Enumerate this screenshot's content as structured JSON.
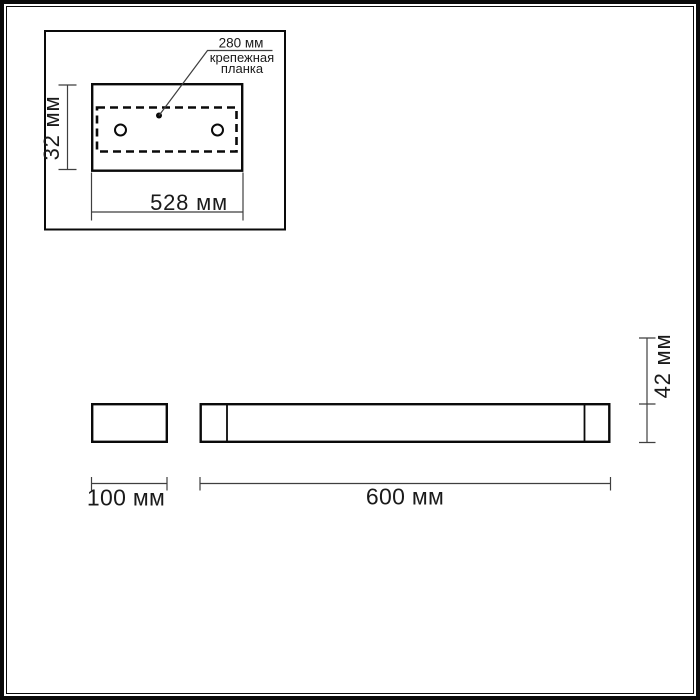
{
  "drawing": {
    "colors": {
      "background": "#ffffff",
      "line": "#0a0a0a",
      "dim_line": "#3f3f3f",
      "text": "#1a1a1a"
    },
    "inset": {
      "hole_spacing_label": "280 мм",
      "part_label_lines": [
        "крепежная",
        "планка"
      ],
      "height_label": "32 мм",
      "width_label": "528 мм"
    },
    "views": {
      "side_width_label": "100 мм",
      "front_width_label": "600 мм",
      "front_height_label": "42 мм"
    }
  }
}
